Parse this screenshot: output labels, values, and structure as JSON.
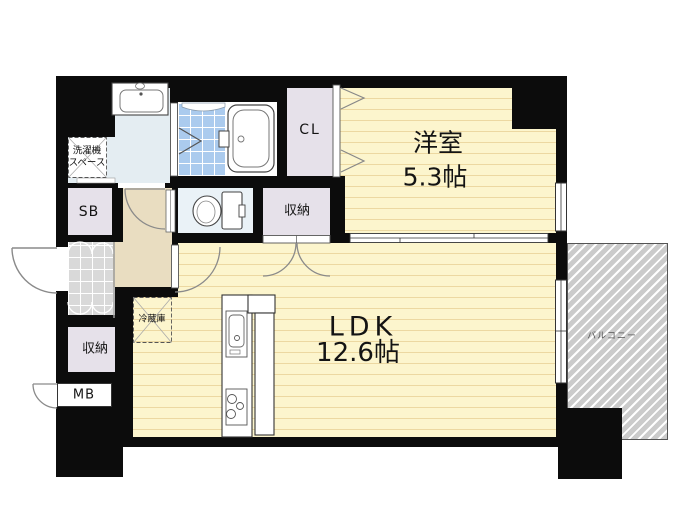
{
  "plan": {
    "type": "apartment-floor-plan",
    "labels": {
      "western_room": {
        "name": "洋室",
        "size": "5.3帖"
      },
      "ldk": {
        "name": "LDK",
        "size": "12.6帖"
      },
      "closet": "CL",
      "shoe_box": "SB",
      "meter_box": "MB",
      "storage_upper": "収納",
      "storage_lower": "収納",
      "washer_space": {
        "line1": "洗濯機",
        "line2": "スペース"
      },
      "refrigerator": "冷蔵庫",
      "balcony": "バルコニー"
    },
    "colors": {
      "wall": "#0c0c0c",
      "room_floor_base": "#fcf5cd",
      "room_floor_stripe": "#ecd8a1",
      "hallway": "#e9ddc1",
      "closet_fill": "#e6e1ea",
      "wet_area_floor": "#e4edf2",
      "bath_tile": "#abcbee",
      "entrance_tile": "#d9d9d9",
      "balcony_fill": "#cbcbcb"
    }
  }
}
